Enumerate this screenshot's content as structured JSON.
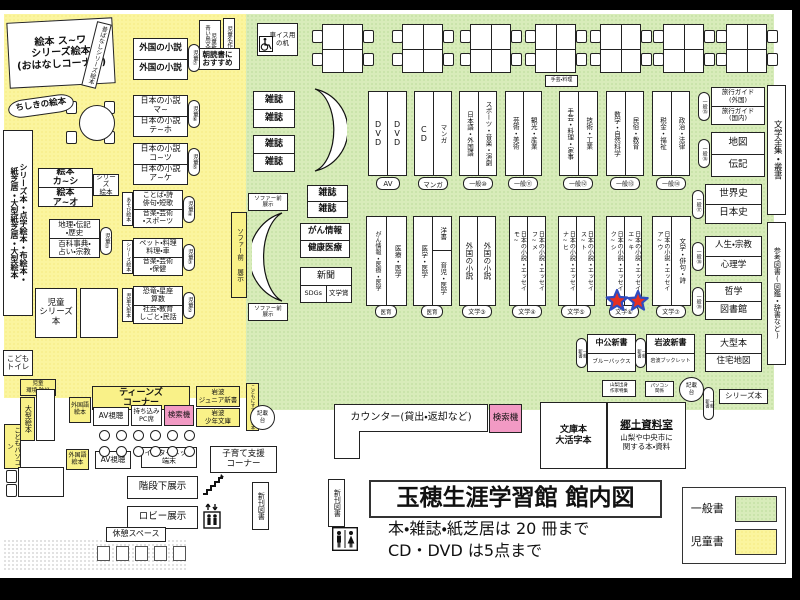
{
  "title": {
    "main": "玉穂生涯学習館 館内図",
    "note1": "本・雑誌・紙芝居は 20 冊まで",
    "note2": "CD・DVD は5点まで"
  },
  "legend": {
    "general": "一般書",
    "children": "児童書"
  },
  "colors": {
    "general_area": "#d8ecba",
    "children_area": "#fbf59e",
    "search_machine": "#f29ac4",
    "star_fill": "#e63022",
    "star_stroke": "#2f4bc0"
  },
  "children": {
    "ohanashi": "絵本 ス~ワ\nシリーズ絵本\n(おはなしコーナー)",
    "mukashi": "昔ばなしシリーズ絵本",
    "chishiki": "ちしきの絵本",
    "wall": "シリーズ本・点字絵本・布絵本・\n紙芝居・大型紙芝居・大型絵本",
    "ehon_up": "絵本\nカ~シ",
    "ehon_low": "絵本\nア~オ",
    "series_ehon": "シリーズ\n絵本",
    "chiri_up": "地理・伝記\n・歴史",
    "chiri_low": "百科事典・\n占い・宗教",
    "tag1": "児童①",
    "kotoba_up": "ことば・詩\n俳句・短歌",
    "kotoba_low": "音楽・芸術\n・スポーツ",
    "kotoba_side": "あそび絵本",
    "tag4": "児童④",
    "pet_up": "ペット・料理\n料理・車",
    "pet_low": "音楽・芸術\n・保健",
    "pet_side": "シリーズ絵本",
    "tag3": "児童③",
    "kyoryu_up": "恐竜・星座\n算数",
    "kyoryu_low": "社会・教育\nしごと・民話",
    "kyoryu_side": "児童大型本",
    "tag2": "児童②",
    "jido_series": "児童\nシリーズ本",
    "toilet": "こども\nトイレ",
    "gaikoku_up": "外国の小説",
    "gaikoku_low": "外国の小説",
    "tag7": "児童⑦",
    "nihon1_up": "日本の小説\nマ~",
    "nihon1_low": "日本の小説\nテ~ホ",
    "tag6": "児童⑥",
    "nihon2_up": "日本の小説\nコ~ツ",
    "nihon2_low": "日本の小説\nア~ケ",
    "tag5": "児童⑤",
    "shinsho_stack": "児童新書\n青い鳥文庫・他",
    "meisaku": "児童名作",
    "asadoku": "朝読書に\nおすすめ",
    "susume": "こどもにすすめたい本"
  },
  "south": {
    "kankyo": "児童\n環境・防災",
    "ogata_ehon": "大型絵本",
    "kodomo_pc": "こどもパソコン",
    "teens": "ティーンズ\nコーナー",
    "gaikokugo": "外国語\n絵本",
    "av": "AV視聴",
    "pc_seat": "持ち込み\nPC席",
    "search": "検索機",
    "iw_junior": "岩波\nジュニア新書",
    "iw_shonen": "岩波\n少年文庫",
    "gaikokugo2": "外国語\n絵本",
    "av2": "AV視聴",
    "internet": "インターネット\n端末",
    "kosodate": "子育て支援\nコーナー",
    "kaidan": "階段下展示",
    "lobby": "ロビー展示",
    "kyukei": "休憩スペース",
    "shinkan": "新刊図書"
  },
  "general": {
    "kurumaisu": "車イス用\nの机",
    "zasshi": "雑誌",
    "gan_up": "がん情報",
    "gan_low": "健康医療",
    "shinbun": "新聞",
    "sdgs": "SDGs",
    "bungakusho": "文学賞",
    "sofa_v": "ソファー前 展示",
    "sofa_s": "ソファー前\n展示",
    "shugei_mini": "手芸・料理",
    "row1": [
      {
        "left": "DVD",
        "right": "DVD",
        "tag": "AV"
      },
      {
        "left": "CD",
        "right": "マンガ",
        "tag": "マンガ"
      },
      {
        "left": "日本語・外国語",
        "right": "スポーツ・音楽・演劇",
        "tag": "一般⑩"
      },
      {
        "left": "芸術・美術",
        "right": "観光・産業",
        "tag": "一般⑪"
      },
      {
        "left": "手芸・料理・家事",
        "right": "技術・工業",
        "tag": "一般⑫"
      },
      {
        "left": "数学・自然科学",
        "right": "民俗・教育",
        "tag": "一般⑬"
      },
      {
        "left": "税金・福祉",
        "right": "政治・法律",
        "tag": "一般⑭"
      }
    ],
    "row2": [
      {
        "left": "がん情報・医療・医学",
        "right": "医療・医学",
        "tag": "医育"
      },
      {
        "left": "医学・医学",
        "right_top": "洋書",
        "right": "育児・医学",
        "tag": "医育"
      },
      {
        "left": "外国の小説",
        "right": "外国の小説",
        "tag": "文学③"
      },
      {
        "left": "日本の小説・エッセイ\nモ~",
        "right": "日本の小説・エッセイ\nフ~メ",
        "tag": "文学④"
      },
      {
        "left": "日本の小説・エッセイ\nナ~ヒ",
        "right": "日本の小説・エッセイ\nス~ト",
        "tag": "文学⑤"
      },
      {
        "left": "日本の小説・エッセイ\nク~シ",
        "right": "日本の小説・エッセイ\nエ~キ",
        "tag": "文学⑥"
      },
      {
        "left": "日本の小説・エッセイ\nア~ウ",
        "right": "文学・俳句・詩",
        "tag": "文学⑦"
      }
    ],
    "right_col": [
      {
        "up": "旅行ガイド\n(外国)",
        "low": "旅行ガイド\n(国内)",
        "tag": "一般⑮"
      },
      {
        "up": "地図",
        "low": "伝記",
        "tag": "一般⑯"
      },
      {
        "up": "世界史",
        "low": "日本史",
        "tag": "一般⑰"
      },
      {
        "up": "人生・宗教",
        "low": "心理学",
        "tag": "一般⑱"
      },
      {
        "up": "哲学",
        "low": "図書館",
        "tag": "一般⑲"
      }
    ],
    "zenshu": "文学全集・叢書",
    "sanko": "参考図書(図鑑・辞書など)",
    "chuko": "中公新書",
    "bluebacks": "ブルーバックス",
    "iwanami": "岩波新書",
    "booklet": "岩波ブックレット",
    "shinsho_tag": "一般\n新書",
    "ogata": "大型本",
    "jutaku": "住宅地図",
    "yamanashi": "山梨出身\n作家特集",
    "pasokon": "パソコン\n関係",
    "kisaidai": "記載\n台",
    "series_bon": "シリーズ本",
    "bunko": "文庫本\n大活字本",
    "kyodo_t": "郷土資料室",
    "kyodo_d": "山梨や中央市に\n関する本・資料",
    "counter": "カウンター(貸出・返却など)",
    "search": "検索機"
  }
}
